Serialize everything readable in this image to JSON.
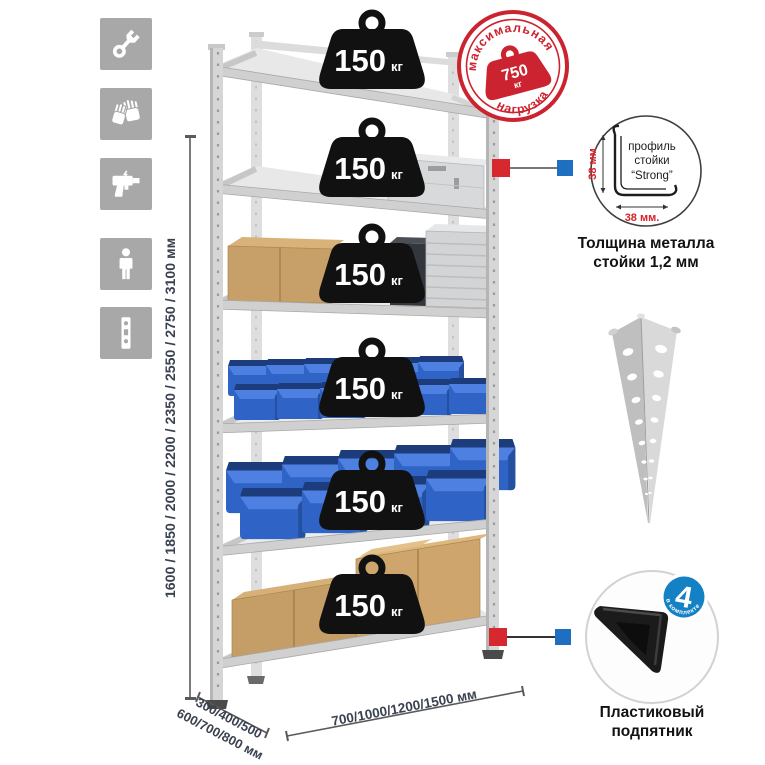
{
  "title": "shelving-rack-infographic",
  "colors": {
    "accent_red": "#d7282f",
    "accent_blue": "#1e6fbf",
    "icon_gray": "#a8a8a9",
    "bin_blue": "#2f63c5",
    "cardboard": "#c7a069",
    "metal": "#d2d2d2",
    "text_dark": "#3a4250",
    "badge_blue": "#1581c5"
  },
  "sidebar": {
    "icons": [
      {
        "name": "wrench-icon"
      },
      {
        "name": "gloves-icon"
      },
      {
        "name": "drill-icon"
      },
      {
        "name": "person-icon"
      },
      {
        "name": "post-profile-icon"
      }
    ]
  },
  "dimensions": {
    "height_label": "1600 / 1850 / 2000 / 2200 / 2350 / 2550 / 2750 / 3100 мм",
    "depth_label_line1": "300/400/500",
    "depth_label_line2": "600/700/800 мм",
    "width_label": "700/1000/1200/1500 мм"
  },
  "rack": {
    "shelf_count": 6,
    "load_value": "150",
    "load_unit": "кг"
  },
  "stamp": {
    "arc_top": "максимальная",
    "arc_bottom": "нагрузка",
    "value": "750",
    "unit": "кг"
  },
  "profile": {
    "line1": "профиль",
    "line2": "стойки",
    "line3": "“Strong”",
    "dim_vertical": "38 мм",
    "dim_horizontal": "38 мм.",
    "caption_line1": "Толщина металла",
    "caption_line2": "стойки 1,2 мм"
  },
  "foot": {
    "badge_value": "4",
    "badge_arc": "в комплекте",
    "caption_line1": "Пластиковый",
    "caption_line2": "подпятник"
  }
}
